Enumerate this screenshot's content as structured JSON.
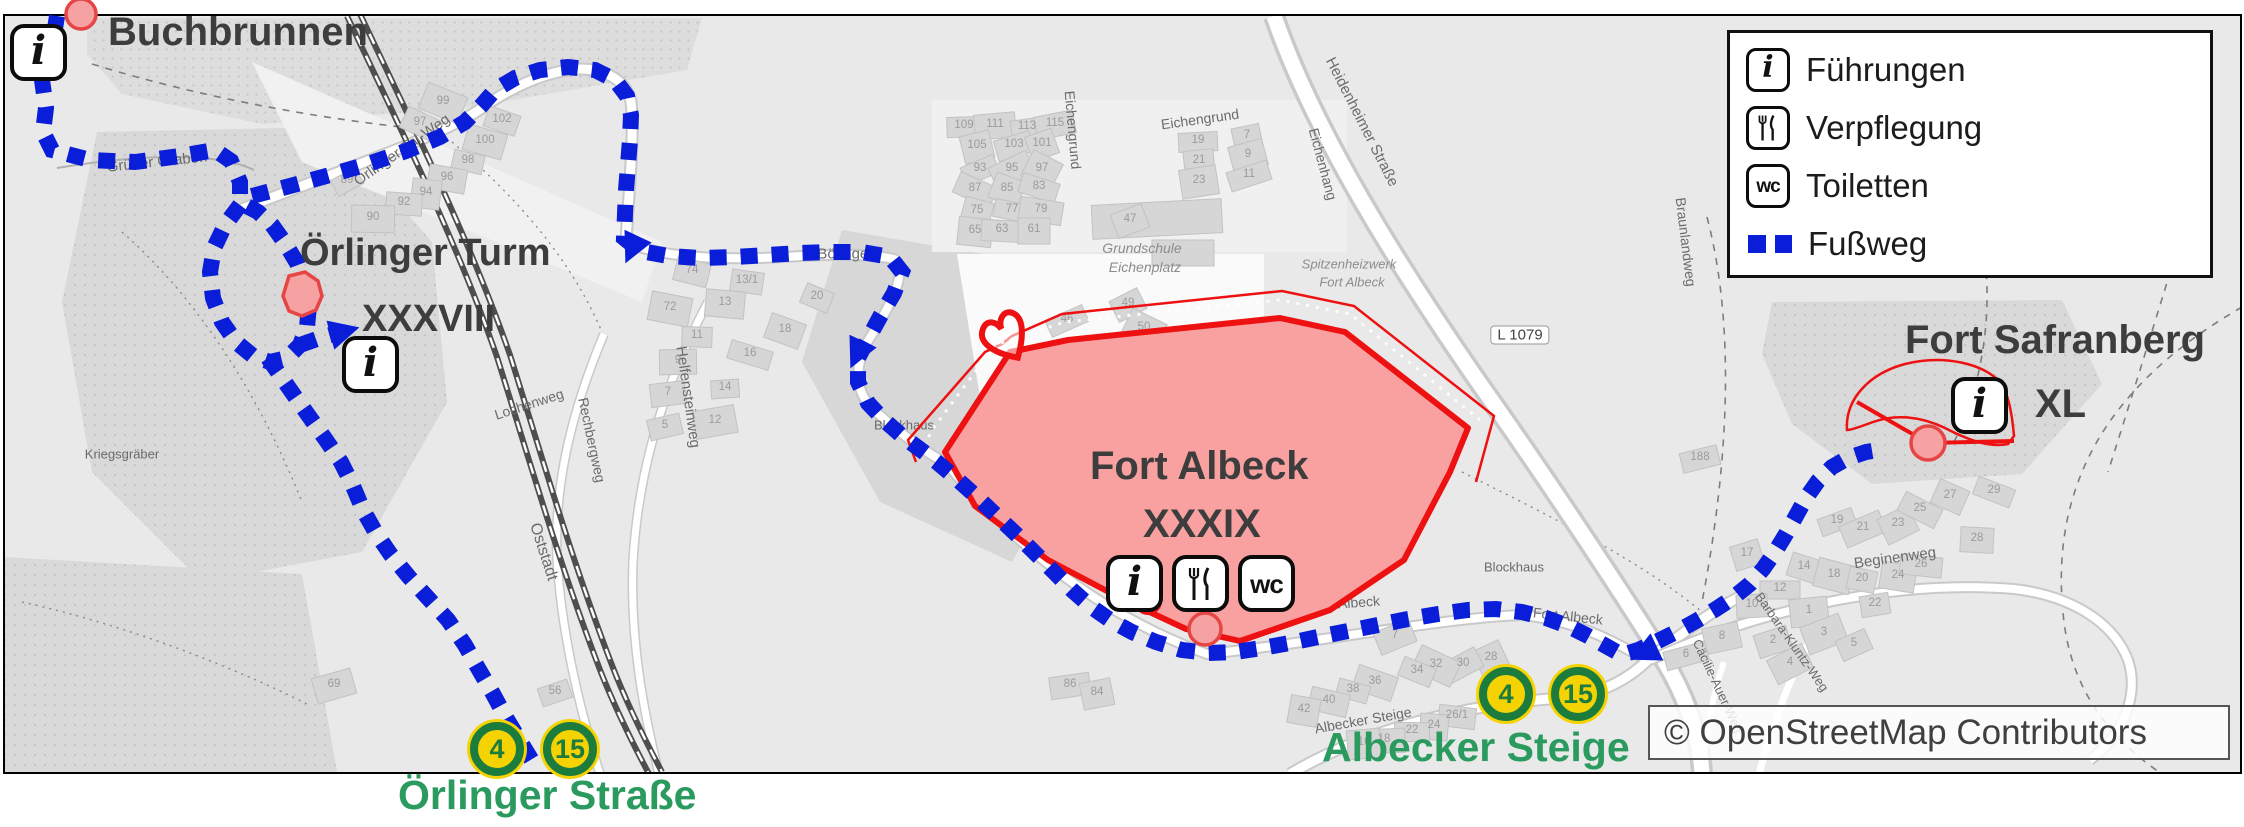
{
  "colors": {
    "route_blue": "#0a1dd8",
    "fort_fill": "#f9a1a1",
    "fort_border": "#ee1111",
    "marker_fill": "#f7a2a2",
    "marker_border": "#e64545",
    "badge_yellow": "#f5d303",
    "badge_green": "#1c7c3d",
    "stop_green": "#2a9a5f",
    "title_gray": "#3d3d3d"
  },
  "icons": {
    "info": "i",
    "wc": "wc"
  },
  "pois": {
    "buchbrunnen": {
      "name": "Buchbrunnen"
    },
    "oerlinger_turm": {
      "name": "Örlinger Turm",
      "numeral": "XXXVIII"
    },
    "fort_albeck": {
      "name": "Fort Albeck",
      "numeral": "XXXIX"
    },
    "fort_safranberg": {
      "name": "Fort Safranberg",
      "numeral": "XL"
    }
  },
  "legend": {
    "items": [
      {
        "icon": "info-icon",
        "label": "Führungen"
      },
      {
        "icon": "restaurant-icon",
        "label": "Verpflegung"
      },
      {
        "icon": "wc-icon",
        "label": "Toiletten"
      },
      {
        "icon": "footpath-swatch",
        "label": "Fußweg"
      }
    ]
  },
  "bus_stops": [
    {
      "name": "Örlinger Straße",
      "lines": [
        "4",
        "15"
      ]
    },
    {
      "name": "Albecker Steige",
      "lines": [
        "4",
        "15"
      ]
    }
  ],
  "attribution": {
    "text": "© OpenStreetMap Contributors"
  },
  "map_labels": [
    {
      "text": "Grüner Graben",
      "x": 155,
      "y": 160,
      "rot": -6,
      "size": 15
    },
    {
      "text": "Örlinger-Tal-Weg",
      "x": 400,
      "y": 148,
      "rot": -35,
      "size": 15
    },
    {
      "text": "Oststadt",
      "x": 541,
      "y": 550,
      "rot": 72,
      "size": 16
    },
    {
      "text": "Helfensteinweg",
      "x": 686,
      "y": 395,
      "rot": 82,
      "size": 15
    },
    {
      "text": "Rechbergweg",
      "x": 590,
      "y": 438,
      "rot": 78,
      "size": 14
    },
    {
      "text": "Lochenweg",
      "x": 527,
      "y": 402,
      "rot": -18,
      "size": 14
    },
    {
      "text": "Böfingen",
      "x": 845,
      "y": 252,
      "rot": 0,
      "size": 15
    },
    {
      "text": "Blockhaus",
      "x": 902,
      "y": 423,
      "rot": 0,
      "size": 13
    },
    {
      "text": "Blockhaus",
      "x": 1512,
      "y": 565,
      "rot": 0,
      "size": 13
    },
    {
      "text": "Grundschule",
      "x": 1140,
      "y": 246,
      "rot": 0,
      "size": 14,
      "italic": true
    },
    {
      "text": "Eichenplatz",
      "x": 1143,
      "y": 265,
      "rot": 0,
      "size": 14,
      "italic": true
    },
    {
      "text": "Eichengrund",
      "x": 1198,
      "y": 117,
      "rot": -8,
      "size": 14
    },
    {
      "text": "Eichengrund",
      "x": 1071,
      "y": 128,
      "rot": 85,
      "size": 14
    },
    {
      "text": "Eichenhang",
      "x": 1321,
      "y": 162,
      "rot": 75,
      "size": 14
    },
    {
      "text": "Heidenheimer Straße",
      "x": 1360,
      "y": 120,
      "rot": 63,
      "size": 15
    },
    {
      "text": "L 1079",
      "x": 1518,
      "y": 333,
      "rot": 0,
      "size": 15,
      "boxed": true
    },
    {
      "text": "Spitzenheizwerk",
      "x": 1347,
      "y": 262,
      "rot": 0,
      "size": 13,
      "italic": true
    },
    {
      "text": "Fort Albeck",
      "x": 1350,
      "y": 280,
      "rot": 0,
      "size": 13,
      "italic": true
    },
    {
      "text": "Braunlandweg",
      "x": 1684,
      "y": 240,
      "rot": 83,
      "size": 14
    },
    {
      "text": "Fort Albeck",
      "x": 1343,
      "y": 601,
      "rot": -4,
      "size": 14
    },
    {
      "text": "Fort Albeck",
      "x": 1566,
      "y": 614,
      "rot": 6,
      "size": 14
    },
    {
      "text": "Albecker Steige",
      "x": 1361,
      "y": 718,
      "rot": -10,
      "size": 14
    },
    {
      "text": "Beginenweg",
      "x": 1893,
      "y": 556,
      "rot": -8,
      "size": 15
    },
    {
      "text": "Barbara-Kluntz-Weg",
      "x": 1790,
      "y": 640,
      "rot": 55,
      "size": 13
    },
    {
      "text": "Cäcilie-Auer-Weg",
      "x": 1716,
      "y": 684,
      "rot": 65,
      "size": 13
    },
    {
      "text": "Kriegsgräber",
      "x": 120,
      "y": 452,
      "rot": 0,
      "size": 13
    }
  ],
  "house_numbers": [
    {
      "n": "89",
      "x": 345,
      "y": 178
    },
    {
      "n": "97",
      "x": 418,
      "y": 120
    },
    {
      "n": "99",
      "x": 441,
      "y": 99
    },
    {
      "n": "102",
      "x": 500,
      "y": 117
    },
    {
      "n": "100",
      "x": 483,
      "y": 138
    },
    {
      "n": "98",
      "x": 466,
      "y": 158
    },
    {
      "n": "96",
      "x": 445,
      "y": 175
    },
    {
      "n": "94",
      "x": 424,
      "y": 190
    },
    {
      "n": "92",
      "x": 402,
      "y": 200
    },
    {
      "n": "90",
      "x": 371,
      "y": 215
    },
    {
      "n": "109",
      "x": 962,
      "y": 123
    },
    {
      "n": "111",
      "x": 993,
      "y": 122
    },
    {
      "n": "113",
      "x": 1025,
      "y": 124
    },
    {
      "n": "115",
      "x": 1053,
      "y": 121
    },
    {
      "n": "105",
      "x": 975,
      "y": 143
    },
    {
      "n": "103",
      "x": 1012,
      "y": 142
    },
    {
      "n": "101",
      "x": 1040,
      "y": 141
    },
    {
      "n": "93",
      "x": 978,
      "y": 166
    },
    {
      "n": "95",
      "x": 1010,
      "y": 166
    },
    {
      "n": "97",
      "x": 1040,
      "y": 166
    },
    {
      "n": "87",
      "x": 973,
      "y": 186
    },
    {
      "n": "85",
      "x": 1005,
      "y": 186
    },
    {
      "n": "83",
      "x": 1037,
      "y": 184
    },
    {
      "n": "75",
      "x": 975,
      "y": 208
    },
    {
      "n": "77",
      "x": 1010,
      "y": 207
    },
    {
      "n": "79",
      "x": 1039,
      "y": 207
    },
    {
      "n": "65",
      "x": 973,
      "y": 228
    },
    {
      "n": "63",
      "x": 1000,
      "y": 227
    },
    {
      "n": "61",
      "x": 1032,
      "y": 227
    },
    {
      "n": "19",
      "x": 1196,
      "y": 138
    },
    {
      "n": "21",
      "x": 1197,
      "y": 158
    },
    {
      "n": "23",
      "x": 1197,
      "y": 178
    },
    {
      "n": "7",
      "x": 1245,
      "y": 133
    },
    {
      "n": "9",
      "x": 1246,
      "y": 152
    },
    {
      "n": "11",
      "x": 1247,
      "y": 172
    },
    {
      "n": "47",
      "x": 1128,
      "y": 217
    },
    {
      "n": "46",
      "x": 1065,
      "y": 317
    },
    {
      "n": "49",
      "x": 1126,
      "y": 301
    },
    {
      "n": "50",
      "x": 1142,
      "y": 325
    },
    {
      "n": "20",
      "x": 815,
      "y": 294
    },
    {
      "n": "18",
      "x": 783,
      "y": 327
    },
    {
      "n": "16",
      "x": 748,
      "y": 351
    },
    {
      "n": "74",
      "x": 690,
      "y": 268
    },
    {
      "n": "72",
      "x": 668,
      "y": 305
    },
    {
      "n": "13/1",
      "x": 745,
      "y": 278
    },
    {
      "n": "13",
      "x": 723,
      "y": 300
    },
    {
      "n": "11",
      "x": 695,
      "y": 333
    },
    {
      "n": "9",
      "x": 676,
      "y": 358
    },
    {
      "n": "14",
      "x": 723,
      "y": 385
    },
    {
      "n": "7",
      "x": 666,
      "y": 390
    },
    {
      "n": "12",
      "x": 713,
      "y": 418
    },
    {
      "n": "5",
      "x": 663,
      "y": 423
    },
    {
      "n": "69",
      "x": 332,
      "y": 682
    },
    {
      "n": "56",
      "x": 553,
      "y": 689
    },
    {
      "n": "7",
      "x": 1393,
      "y": 633
    },
    {
      "n": "28",
      "x": 1489,
      "y": 655
    },
    {
      "n": "30",
      "x": 1461,
      "y": 661
    },
    {
      "n": "32",
      "x": 1434,
      "y": 662
    },
    {
      "n": "34",
      "x": 1415,
      "y": 668
    },
    {
      "n": "36",
      "x": 1373,
      "y": 679
    },
    {
      "n": "38",
      "x": 1351,
      "y": 687
    },
    {
      "n": "40",
      "x": 1327,
      "y": 698
    },
    {
      "n": "42",
      "x": 1302,
      "y": 707
    },
    {
      "n": "26/1",
      "x": 1455,
      "y": 713
    },
    {
      "n": "24",
      "x": 1432,
      "y": 723
    },
    {
      "n": "22",
      "x": 1410,
      "y": 728
    },
    {
      "n": "18",
      "x": 1382,
      "y": 737
    },
    {
      "n": "16",
      "x": 1362,
      "y": 740
    },
    {
      "n": "86",
      "x": 1068,
      "y": 682
    },
    {
      "n": "84",
      "x": 1095,
      "y": 690
    },
    {
      "n": "188",
      "x": 1698,
      "y": 455
    },
    {
      "n": "17",
      "x": 1745,
      "y": 551
    },
    {
      "n": "19",
      "x": 1835,
      "y": 518
    },
    {
      "n": "21",
      "x": 1861,
      "y": 525
    },
    {
      "n": "23",
      "x": 1896,
      "y": 521
    },
    {
      "n": "25",
      "x": 1918,
      "y": 506
    },
    {
      "n": "27",
      "x": 1948,
      "y": 493
    },
    {
      "n": "29",
      "x": 1992,
      "y": 488
    },
    {
      "n": "14",
      "x": 1802,
      "y": 564
    },
    {
      "n": "18",
      "x": 1832,
      "y": 572
    },
    {
      "n": "20",
      "x": 1860,
      "y": 576
    },
    {
      "n": "24",
      "x": 1896,
      "y": 573
    },
    {
      "n": "26",
      "x": 1919,
      "y": 562
    },
    {
      "n": "28",
      "x": 1975,
      "y": 536
    },
    {
      "n": "12",
      "x": 1778,
      "y": 586
    },
    {
      "n": "10",
      "x": 1750,
      "y": 602
    },
    {
      "n": "1",
      "x": 1807,
      "y": 608
    },
    {
      "n": "22",
      "x": 1873,
      "y": 601
    },
    {
      "n": "8",
      "x": 1720,
      "y": 634
    },
    {
      "n": "6",
      "x": 1684,
      "y": 652
    },
    {
      "n": "2",
      "x": 1771,
      "y": 638
    },
    {
      "n": "3",
      "x": 1822,
      "y": 630
    },
    {
      "n": "5",
      "x": 1852,
      "y": 641
    },
    {
      "n": "4",
      "x": 1788,
      "y": 660
    }
  ]
}
